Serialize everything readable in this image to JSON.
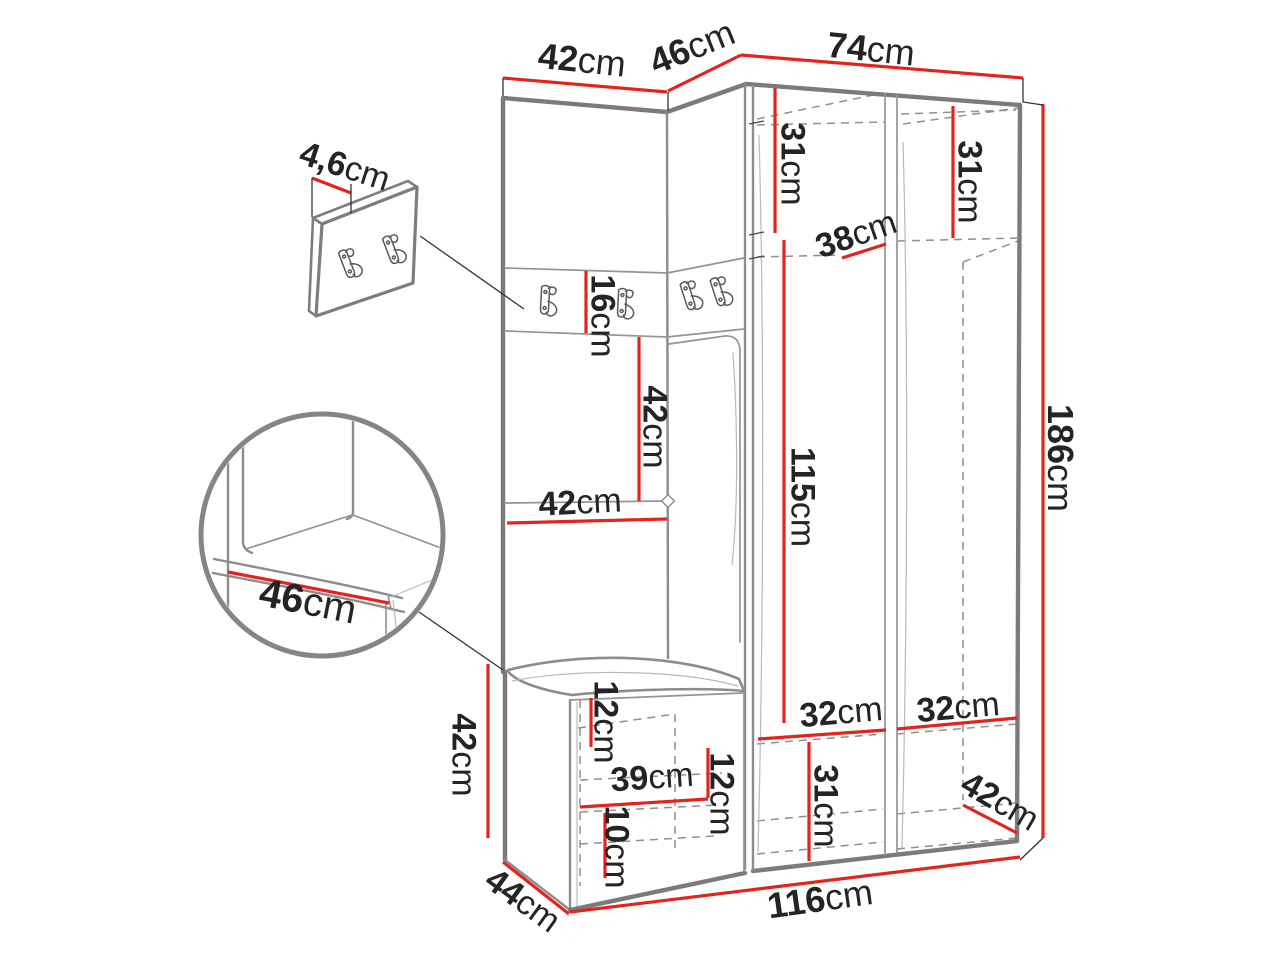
{
  "figure": {
    "type": "furniture-dimension-diagram",
    "subject": "hallway wardrobe set with bench, coat hooks and wall hook panel",
    "unit": "cm"
  },
  "colors": {
    "dimension_line": "#e3231e",
    "label_text": "#242424",
    "structure": "#7b7b7b",
    "background": "#ffffff"
  },
  "icons": {
    "hook": "double-coat-hook"
  },
  "measurements": [
    {
      "name": "top-left-width",
      "text": "42cm",
      "x": 582,
      "y": 60,
      "r": 6,
      "s": 36
    },
    {
      "name": "top-corner-width",
      "text": "46cm",
      "x": 692,
      "y": 47,
      "r": -22,
      "s": 36
    },
    {
      "name": "top-right-width",
      "text": "74cm",
      "x": 871,
      "y": 49,
      "r": 6,
      "s": 36
    },
    {
      "name": "panel-thickness",
      "text": "4,6cm",
      "x": 345,
      "y": 166,
      "r": 18,
      "s": 34
    },
    {
      "name": "seat-depth-detail",
      "text": "46cm",
      "x": 308,
      "y": 601,
      "r": 11,
      "s": 40
    },
    {
      "name": "hook-strip-height",
      "text": "16cm",
      "x": 603,
      "y": 316,
      "r": 90,
      "s": 34
    },
    {
      "name": "mirror-height",
      "text": "42cm",
      "x": 655,
      "y": 427,
      "r": 90,
      "s": 34
    },
    {
      "name": "left-column-width",
      "text": "42cm",
      "x": 580,
      "y": 502,
      "r": -3,
      "s": 34
    },
    {
      "name": "upper-shelf-left",
      "text": "31cm",
      "x": 793,
      "y": 164,
      "r": 90,
      "s": 34
    },
    {
      "name": "upper-shelf-right",
      "text": "31cm",
      "x": 970,
      "y": 182,
      "r": 90,
      "s": 34
    },
    {
      "name": "shelf-depth",
      "text": "38cm",
      "x": 856,
      "y": 234,
      "r": -19,
      "s": 34
    },
    {
      "name": "hanging-space-height",
      "text": "115cm",
      "x": 803,
      "y": 497,
      "r": 90,
      "s": 34
    },
    {
      "name": "total-height",
      "text": "186cm",
      "x": 1060,
      "y": 458,
      "r": 90,
      "s": 36
    },
    {
      "name": "lower-shelf-width-l",
      "text": "32cm",
      "x": 841,
      "y": 712,
      "r": -5,
      "s": 34
    },
    {
      "name": "lower-shelf-width-r",
      "text": "32cm",
      "x": 958,
      "y": 707,
      "r": -5,
      "s": 34
    },
    {
      "name": "lower-shelf-height",
      "text": "31cm",
      "x": 826,
      "y": 806,
      "r": 90,
      "s": 34
    },
    {
      "name": "bench-height",
      "text": "42cm",
      "x": 464,
      "y": 755,
      "r": 90,
      "s": 34
    },
    {
      "name": "bench-upper-gap",
      "text": "12cm",
      "x": 606,
      "y": 722,
      "r": 90,
      "s": 34
    },
    {
      "name": "bench-shelf-width",
      "text": "39cm",
      "x": 652,
      "y": 777,
      "r": -4,
      "s": 34
    },
    {
      "name": "bench-mid-gap",
      "text": "12cm",
      "x": 722,
      "y": 794,
      "r": 90,
      "s": 34
    },
    {
      "name": "bench-lower-gap",
      "text": "10cm",
      "x": 617,
      "y": 847,
      "r": 90,
      "s": 34
    },
    {
      "name": "bottom-right-depth",
      "text": "42cm",
      "x": 1000,
      "y": 801,
      "r": 30,
      "s": 34
    },
    {
      "name": "bench-depth",
      "text": "44cm",
      "x": 523,
      "y": 900,
      "r": 36,
      "s": 34
    },
    {
      "name": "total-width",
      "text": "116cm",
      "x": 820,
      "y": 899,
      "r": -8,
      "s": 36
    }
  ]
}
